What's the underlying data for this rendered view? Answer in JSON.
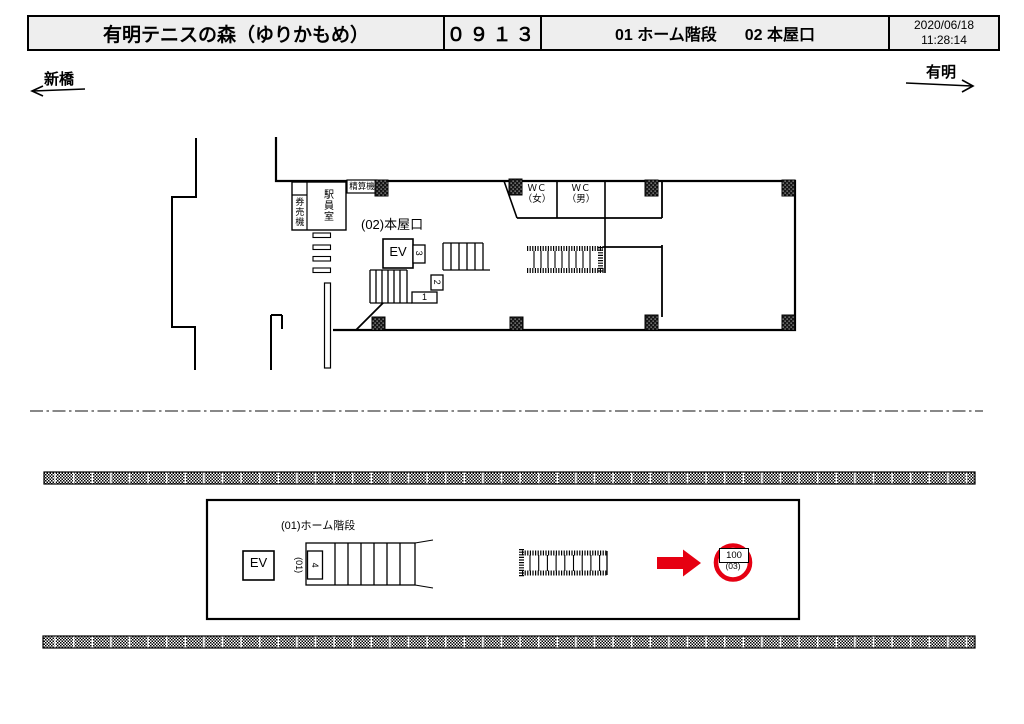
{
  "header": {
    "station_name": "有明テニスの森（ゆりかもめ）",
    "station_code": "０９１３",
    "exit_01": "01 ホーム階段",
    "exit_02": "02 本屋口",
    "date": "2020/06/18",
    "time": "11:28:14"
  },
  "directions": {
    "left": "新橋",
    "right": "有明"
  },
  "concourse": {
    "ticket_machine_label": "券売機",
    "staff_room_label": "駅員室",
    "fare_adjustment_label": "精算機",
    "exit_label": "(02)本屋口",
    "elevator_label": "EV",
    "wc_women_line1": "ＷＣ",
    "wc_women_line2": "（女）",
    "wc_men_line1": "ＷＣ",
    "wc_men_line2": "（男）",
    "stair_section_3": "3",
    "stair_section_2": "2",
    "stair_section_1": "1"
  },
  "platform": {
    "stair_label": "(01)ホーム階段",
    "elevator_label": "EV",
    "stair_ref_label": "(01)",
    "stair_section_4": "4",
    "marker_value": "100",
    "marker_ref": "(03)"
  },
  "colors": {
    "accent_red": "#e60012"
  }
}
